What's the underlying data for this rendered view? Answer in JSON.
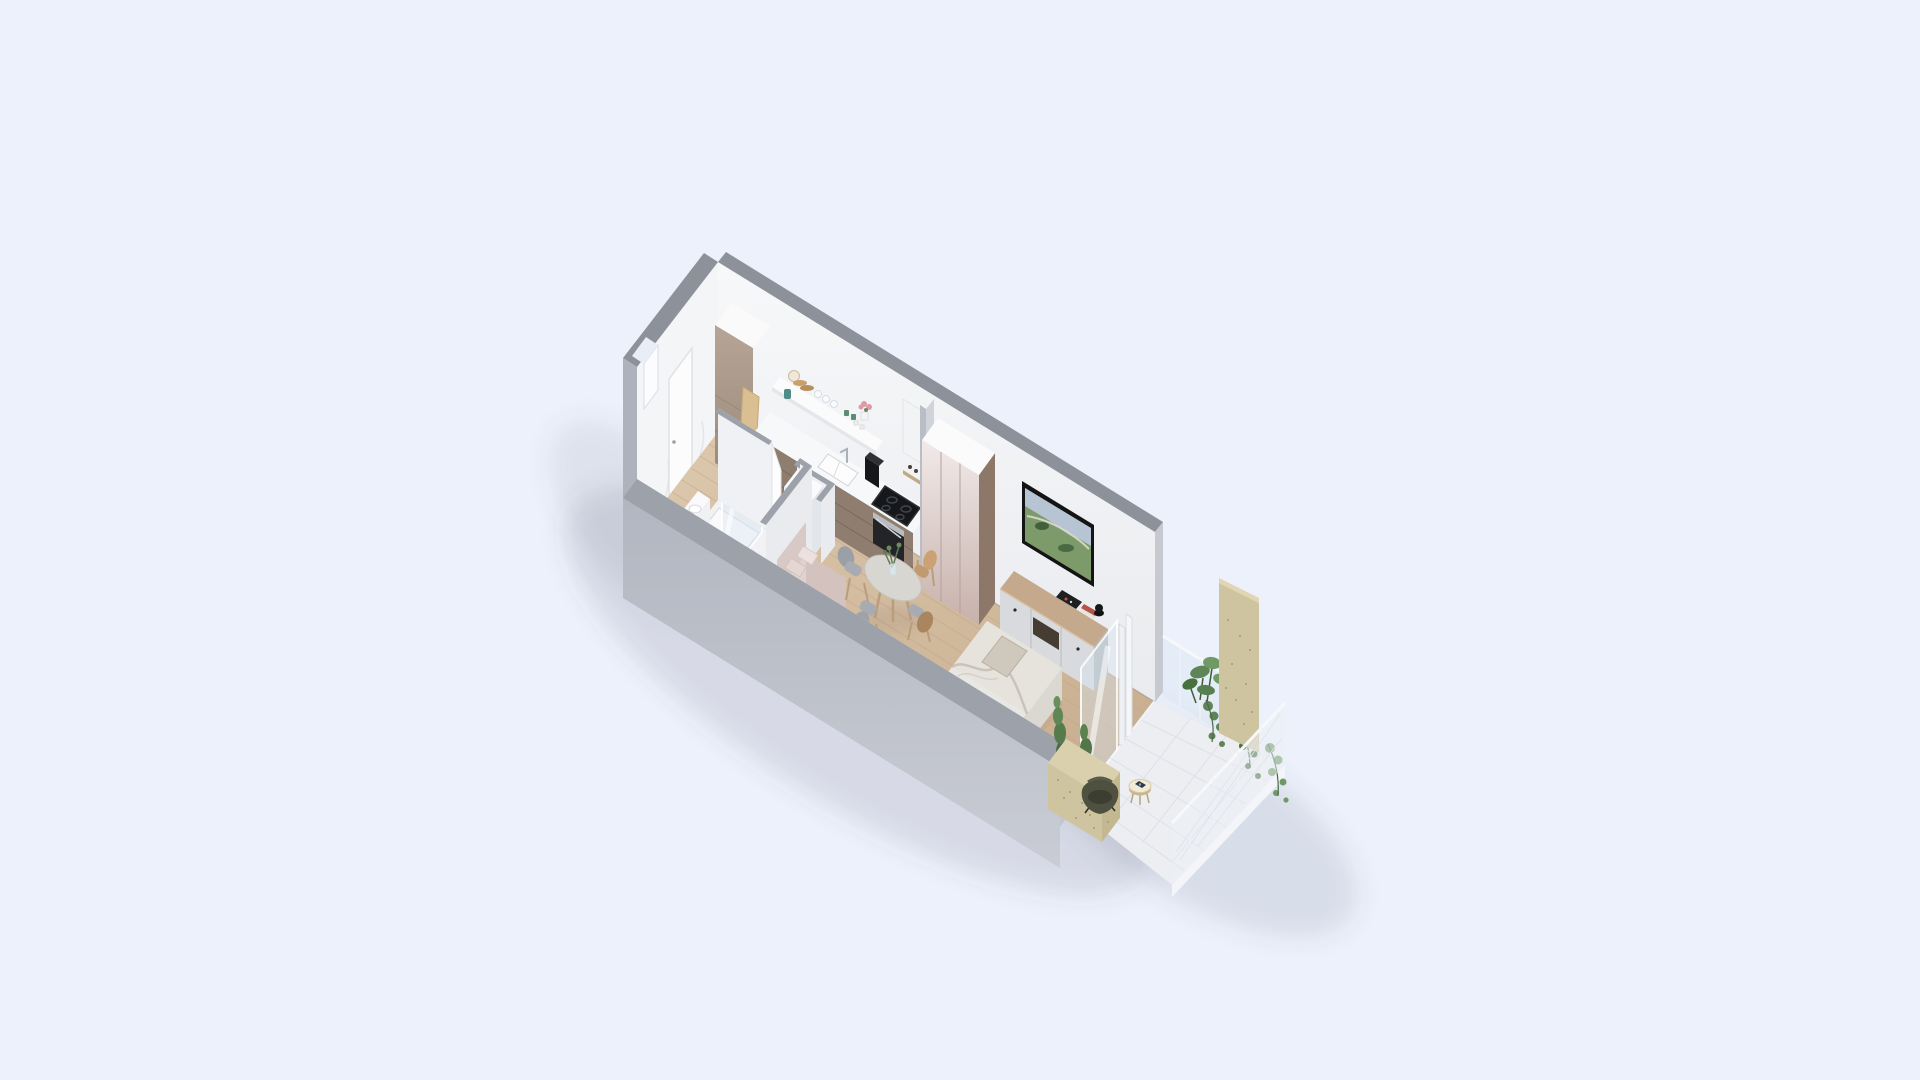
{
  "scene": {
    "type": "isometric-3d-floor-plan-render",
    "background": "#edf1fb",
    "palette": {
      "wallTop": "#8d919a",
      "wallFace": "#f4f5f7",
      "wallOuterCap": "#aeb2bc",
      "lowWallTop": "#9da1aa",
      "lowWallInner": "#dadde2",
      "endCap": "#c6c9d0",
      "marble": "#f2f2f5",
      "counterTop": "#f7f8f9",
      "cabinetFront": "#8f7e6f",
      "wardrobeSide": "#8c7769",
      "consoleFront": "#d9dadd",
      "woodTop": "#c4a98c",
      "bedLinen": "#e9e7e3",
      "sofa": "#e0d2cf",
      "tableTop": "#d8d6d1",
      "chairGray": "#a8abb1",
      "tvFrame": "#141414",
      "screenSky": "#b6c4d4",
      "screenLand": "#7d9a6b",
      "tile": "#eceef2",
      "plywood": "#cfc4a0",
      "plantMid": "#5e8457",
      "plantDark": "#49703f",
      "plantLight": "#6f9a63",
      "glass": "rgba(214,228,240,0.42)",
      "applianceBlack": "#16171a",
      "trayWhite": "#fafafc",
      "potBlue": "#6aa7c8",
      "flowerPink": "#e09aa6"
    },
    "rooms": [
      "entry",
      "bathroom",
      "kitchen",
      "living-sleeping-area",
      "balcony"
    ],
    "furniture": [
      "entrance-door",
      "tall-cabinet",
      "kitchen-counter",
      "sink",
      "cooktop",
      "oven",
      "open-shelf",
      "wardrobe",
      "tv",
      "tv-console",
      "dining-table",
      "dining-chairs",
      "sofa",
      "double-bed",
      "shower",
      "toilet",
      "washer-cabinet",
      "sliding-glass-door",
      "butterfly-chair",
      "side-table",
      "balcony-plants",
      "plywood-privacy-panel",
      "glass-railing"
    ]
  }
}
